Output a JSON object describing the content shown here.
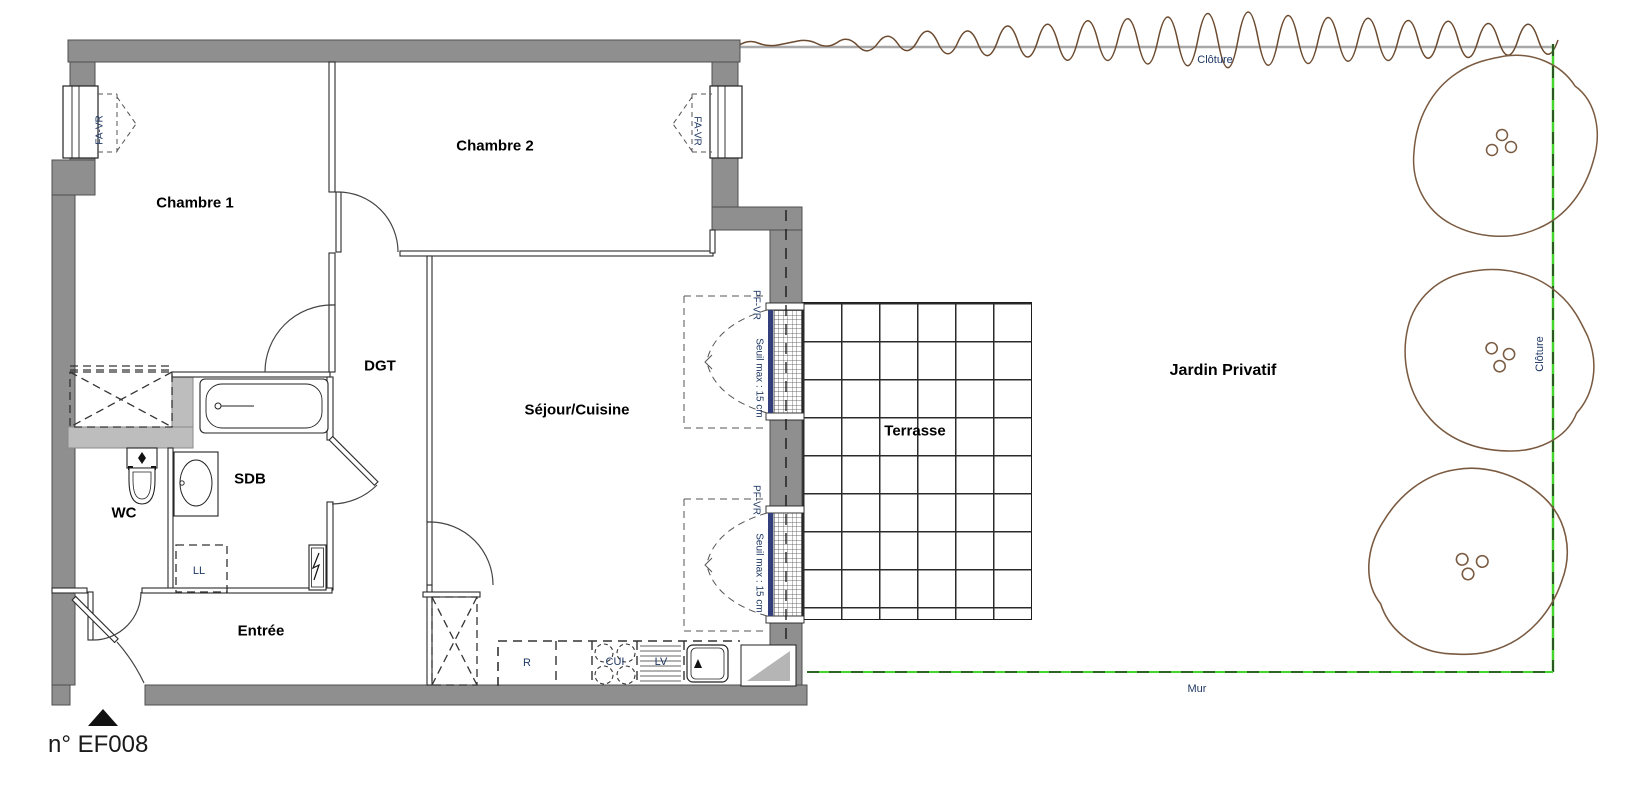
{
  "plan": {
    "number": "n° EF008",
    "rooms": {
      "chambre1": "Chambre 1",
      "chambre2": "Chambre 2",
      "dgt": "DGT",
      "sdb": "SDB",
      "wc": "WC",
      "entree": "Entrée",
      "sejour": "Séjour/Cuisine",
      "terrasse": "Terrasse",
      "jardin": "Jardin Privatif"
    },
    "boundaries": {
      "cloture_top": "Clôture",
      "cloture_right": "Clôture",
      "mur": "Mur"
    },
    "windows": {
      "fa_vr_left": "FA-VR",
      "fa_vr_right": "FA-VR",
      "pf_vr_1": "PF-VR",
      "pf_vr_2": "PF-VR",
      "seuil_1": "Seuil max : 15 cm",
      "seuil_2": "Seuil max : 15 cm"
    },
    "appliances": {
      "fridge": "R",
      "washer": "LL",
      "dishwasher": "LV",
      "cooktop": "CUI"
    },
    "colors": {
      "wall_gray": "#8f8f8f",
      "wall_light": "#bdbdbd",
      "fence_green": "#44d62c",
      "window_blue": "#333f7d",
      "tree_brown": "#7a5a40",
      "label_navy": "#1f3864"
    }
  }
}
